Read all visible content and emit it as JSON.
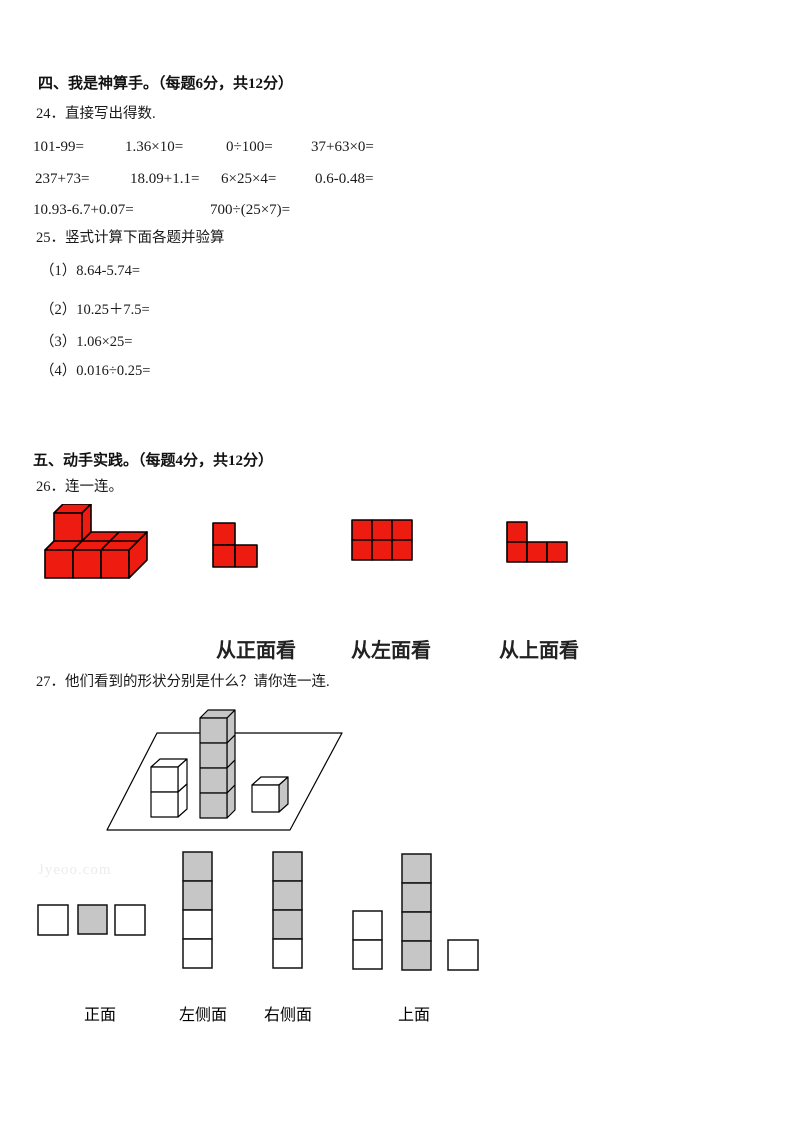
{
  "watermark": "Jyeoo.com",
  "colors": {
    "cube_red": "#ee1b10",
    "cube_gray": "#c6c6c6"
  },
  "section4": {
    "title": "四、我是神算手。（每题6分，共12分）",
    "q24": {
      "label": "24．直接写出得数.",
      "rows": [
        [
          "101-99=",
          "1.36×10=",
          "0÷100=",
          "37+63×0="
        ],
        [
          "237+73=",
          "18.09+1.1=",
          "6×25×4=",
          "0.6-0.48="
        ],
        [
          "10.93-6.7+0.07=",
          "700÷(25×7)="
        ]
      ]
    },
    "q25": {
      "label": "25．竖式计算下面各题并验算",
      "items": [
        "（1）8.64-5.74=",
        "（2）10.25＋7.5=",
        "（3）1.06×25=",
        "（4）0.016÷0.25="
      ]
    }
  },
  "section5": {
    "title": "五、动手实践。（每题4分，共12分）",
    "q26": {
      "label": "26．连一连。",
      "view_labels": [
        "从正面看",
        "从左面看",
        "从上面看"
      ],
      "figures": [
        "red-3d-cube-solid",
        "red-l-shape-3",
        "red-rect-2x3",
        "red-l-shape-4"
      ]
    },
    "q27": {
      "label": "27．他们看到的形状分别是什么？请你连一连.",
      "answer_labels": [
        "正面",
        "左侧面",
        "右侧面",
        "上面"
      ]
    }
  }
}
